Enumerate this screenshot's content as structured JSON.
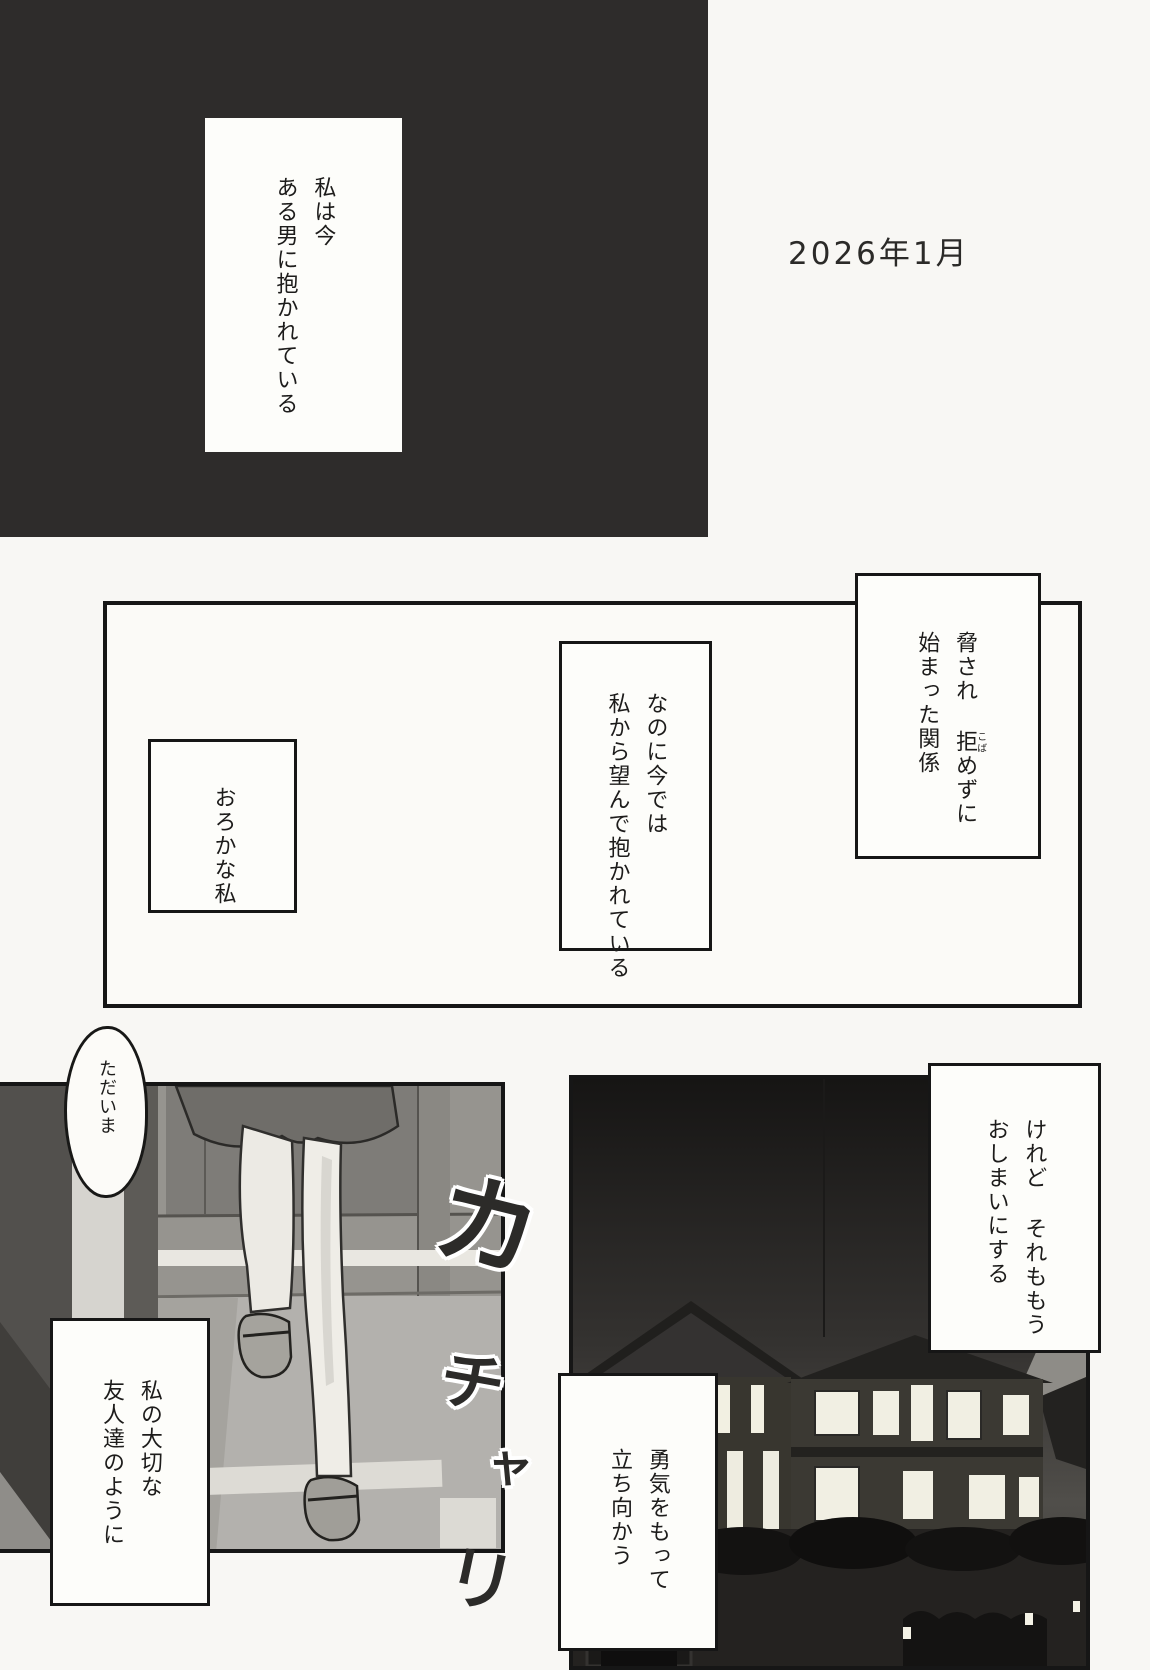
{
  "page": {
    "date": "2026年1月"
  },
  "monologue": {
    "intro": {
      "line1": "私は今",
      "line2": "ある男に抱かれている"
    },
    "threat": {
      "line1_pre": "脅され ",
      "line1_kanji": "拒",
      "line1_furigana": "こば",
      "line1_post": "めずに",
      "line2": "始まった関係"
    },
    "nanoni": {
      "line1": "なのに今では",
      "line2": "私から望んで抱かれている"
    },
    "oroka": {
      "line1": "おろかな私"
    },
    "keredo": {
      "line1": "けれど それももう",
      "line2": "おしまいにする"
    },
    "yuuki": {
      "line1": "勇気をもって",
      "line2": "立ち向かう"
    },
    "watashi": {
      "line1": "私の大切な",
      "line2": "友人達のように"
    }
  },
  "speech": {
    "tadaima": "ただいま"
  },
  "sfx": {
    "ka": "カ",
    "chi": "チ",
    "ya": "ャ",
    "ri": "リ"
  },
  "colors": {
    "panel_black": "#2e2c2b",
    "ink": "#161616",
    "paper": "#f8f7f4"
  }
}
